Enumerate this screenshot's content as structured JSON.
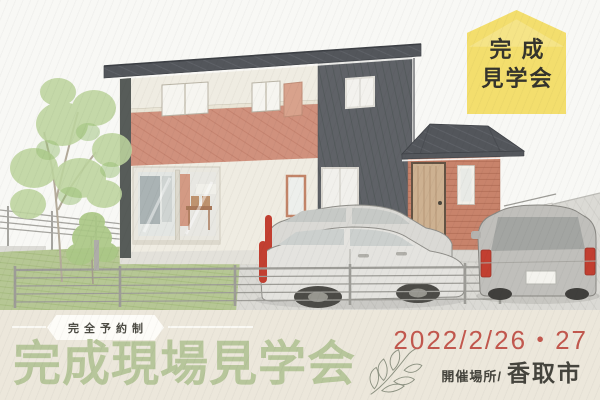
{
  "page": {
    "type": "housing-open-house-ad-banner",
    "width": 600,
    "height": 400
  },
  "badge": {
    "line1": "完成",
    "line2": "見学会"
  },
  "banner": {
    "ribbon_label": "完全予約制",
    "title": "完成現場見学会",
    "date": "2022/2/26・27",
    "venue_label": "開催場所/",
    "venue_name": "香取市"
  },
  "illustration": {
    "scene": "hand-drawn two-story house with charcoal roof, cream walls, salmon balcony band, brick entrance wing with wooden door, two white cars and one gray car parked, garden tree, lawn and low metal fence"
  },
  "palette": {
    "badge_yellow": "#f3de6d",
    "badge_text": "#35342d",
    "band_beige": "#ece7db",
    "title_green": "#b7c69b",
    "date_red": "#c2584e",
    "text_dark": "#45443d",
    "ribbon_white": "#fdfcf8",
    "roof_gray": "#53565b",
    "dark_wall": "#5f6267",
    "cream_wall": "#efece2",
    "balcony_pink": "#d0917d",
    "brick_orange": "#c8836b",
    "lawn_green": "#b6c794",
    "car_red_accent": "#c23f31"
  }
}
